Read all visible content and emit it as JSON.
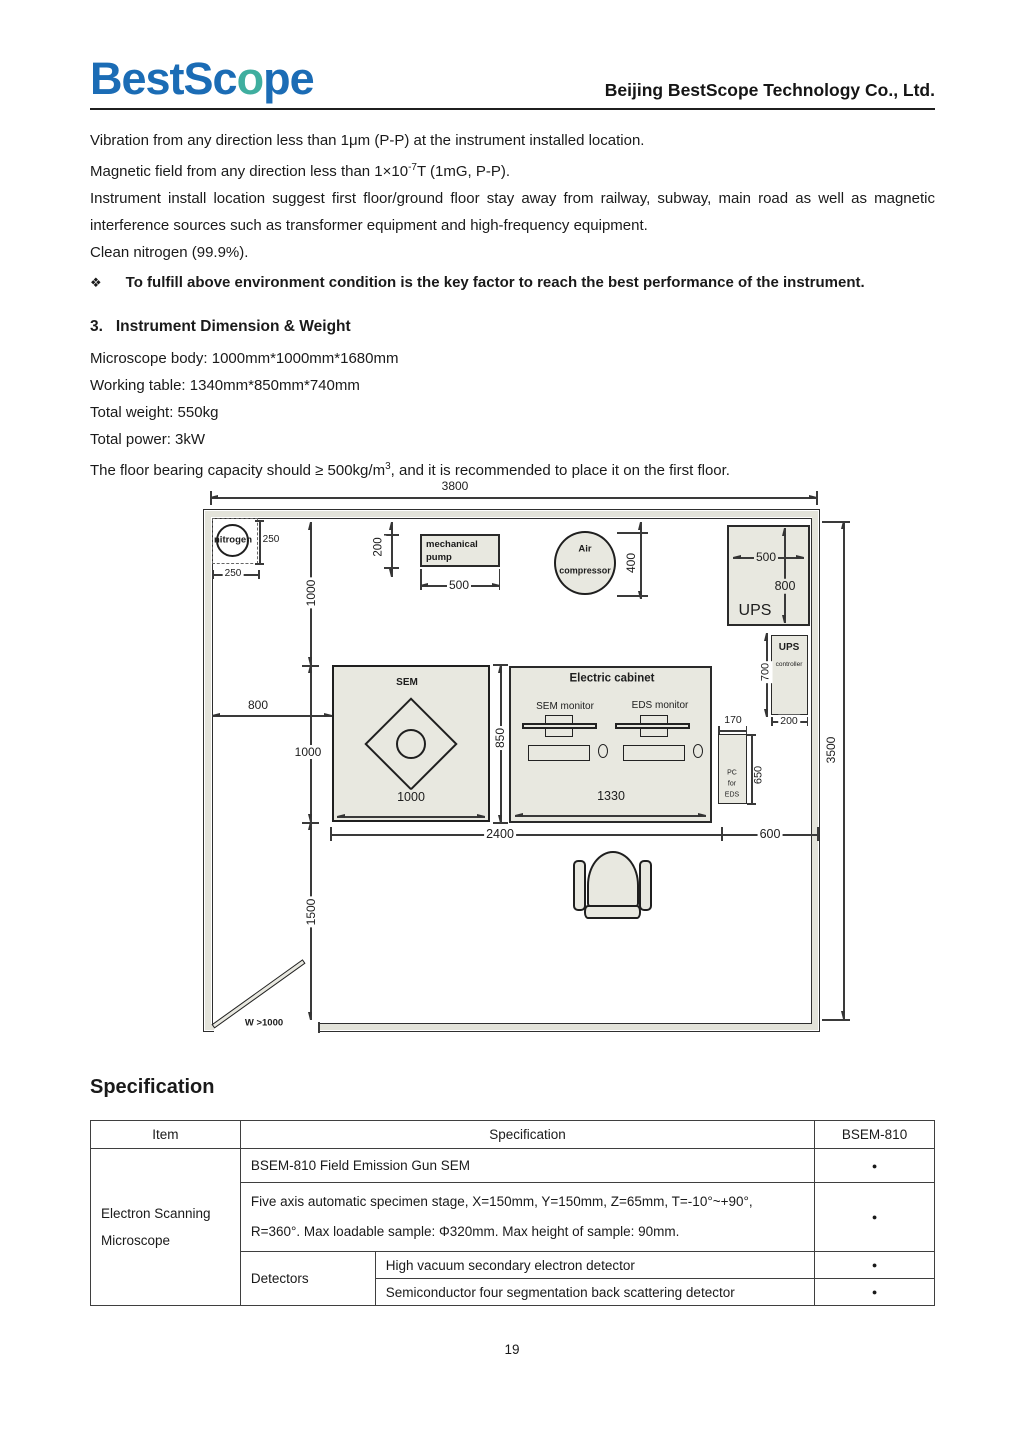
{
  "header": {
    "logo": {
      "part1": "BestSc",
      "o": "o",
      "part2": "pe"
    },
    "company": "Beijing BestScope Technology Co., Ltd.",
    "colors": {
      "logo_blue": "#1b6cb5",
      "logo_teal": "#3fae9f",
      "fill_beige": "#e8e8e0"
    }
  },
  "environment": {
    "line_vibration": "Vibration from any direction less than 1μm (P-P) at the instrument installed location.",
    "line_magnetic_pre": "Magnetic field from any direction less than 1×10",
    "line_magnetic_sup": "-7",
    "line_magnetic_post": "T (1mG, P-P).",
    "line_location": "Instrument install location suggest first floor/ground floor stay away from railway, subway, main road as well as magnetic interference sources such as transformer equipment and high-frequency equipment.",
    "line_nitrogen": "Clean nitrogen (99.9%).",
    "bullet_marker": "❖",
    "bullet_text": "To fulfill above environment condition is the key factor to reach the best performance of the instrument."
  },
  "section3": {
    "number": "3.",
    "title": "Instrument Dimension & Weight",
    "body_line": "Microscope body: 1000mm*1000mm*1680mm",
    "table_line": "Working table: 1340mm*850mm*740mm",
    "weight_line": "Total weight: 550kg",
    "power_line": "Total power: 3kW",
    "floor_pre": "The floor bearing capacity should ≥ 500kg/m",
    "floor_sup": "3",
    "floor_post": ", and it is recommended to place it on the first floor."
  },
  "floor_plan": {
    "dims": {
      "room_width": "3800",
      "room_height": "3500",
      "nitrogen_w": "250",
      "nitrogen_h": "250",
      "wall_to_sem_top": "1000",
      "pump_depth": "200",
      "pump_width": "500",
      "compressor_d": "400",
      "ups_w": "500",
      "ups_h": "800",
      "ups_ctrl_h": "700",
      "ups_ctrl_w": "200",
      "wall_to_sem_left": "800",
      "sem_h": "1000",
      "sem_w": "1000",
      "cabinet_h": "850",
      "cabinet_w": "1330",
      "pc_w": "170",
      "pc_h": "650",
      "span_bottom_left": "2400",
      "span_bottom_right": "600",
      "sem_to_wall_bottom": "1500",
      "door_width": "W >1000"
    },
    "labels": {
      "nitrogen": "nitrogen",
      "pump_l1": "mechanical",
      "pump_l2": "pump",
      "compressor_l1": "Air",
      "compressor_l2": "compressor",
      "ups": "UPS",
      "ups_ctrl_l1": "UPS",
      "ups_ctrl_l2": "controller",
      "sem": "SEM",
      "cabinet": "Electric cabinet",
      "sem_monitor": "SEM monitor",
      "eds_monitor": "EDS monitor",
      "pc_l1": "PC",
      "pc_l2": "for",
      "pc_l3": "EDS"
    }
  },
  "specification": {
    "heading": "Specification",
    "table": {
      "headers": {
        "item": "Item",
        "spec": "Specification",
        "model": "BSEM-810"
      },
      "item_group": "Electron Scanning Microscope",
      "detectors_group": "Detectors",
      "rows": {
        "r1": {
          "spec": "BSEM-810 Field Emission Gun SEM",
          "dot": "●"
        },
        "r2": {
          "line1": "Five axis automatic specimen stage, X=150mm, Y=150mm, Z=65mm, T=-10°~+90°,",
          "line2": "R=360°. Max loadable sample: Φ320mm. Max height of sample: 90mm.",
          "dot": "●"
        },
        "r3": {
          "spec": "High vacuum secondary electron detector",
          "dot": "●"
        },
        "r4": {
          "spec": "Semiconductor four segmentation back scattering detector",
          "dot": "●"
        }
      }
    }
  },
  "footer": {
    "page_number": "19"
  }
}
